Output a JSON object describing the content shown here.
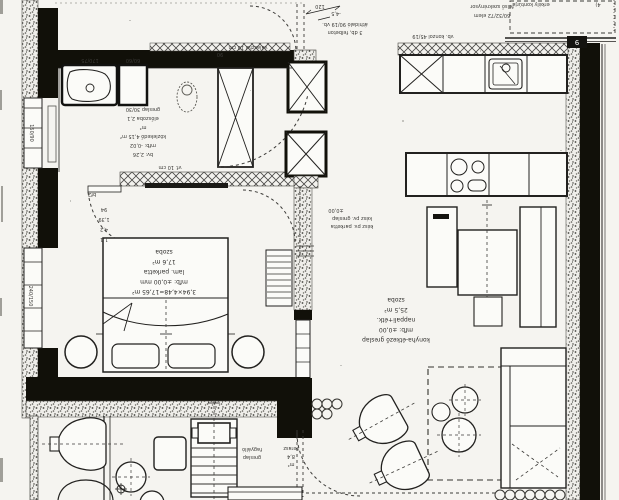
{
  "document": {
    "type": "scanned floor plan (rotated 180°)",
    "badge": "9",
    "corner_mark": "4)"
  },
  "colors": {
    "paper": "#f5f4f0",
    "ink": "#22211f",
    "wall_black": "#111009",
    "hatch": "#4a4947",
    "dash": "#3c3b38"
  },
  "labels": {
    "bath": {
      "lines": [
        "greslap 30/30",
        "előszoba 2,1",
        "m²",
        "közlekedő 4,15 m²",
        "mfb: -0,02",
        "bv: 2,26"
      ]
    },
    "bedroom": {
      "lines": [
        "szoba",
        "17,6 m²",
        "lam. parketta",
        "mfb: ±0,00 mm",
        "3,94×4,48=17,65 m²"
      ]
    },
    "living": {
      "lines": [
        "szoba",
        "25,5 m²",
        "nappali+étk.",
        "mfb: ±0,00",
        "konyha-étkező greslap"
      ]
    },
    "level_note": {
      "lines": [
        "±0,00",
        "kész pv. greslap",
        "kész pv. parketta"
      ]
    },
    "top_note": {
      "lines": [
        "áthidaló 90/19 vb.",
        "3 db, felbeton"
      ],
      "dim": "120",
      "mark": "-4,5"
    },
    "kitchen_note": {
      "lines": [
        "felső szekrénysor",
        "60/32/72 elem"
      ]
    },
    "terrace": {
      "note_lines": [
        "fagyálló",
        "greslap"
      ],
      "col_lines": [
        "terasz",
        "8,4",
        "m²"
      ]
    },
    "hatch_label_top": "válaszfal 10 cm",
    "hatch_label_mid": "vf. 10 cm",
    "kitchen_hatch_label": "vb. konzol 45/19",
    "balcony_note": "erkély kontúrja",
    "door_code": "bf2",
    "entry_dim": "90",
    "dim_stack": [
      "94",
      "1,39",
      "4,2",
      "1,1"
    ],
    "window_left": "150/90",
    "window_bedroom": "240/150",
    "fixture_tub": "170/75",
    "fixture_shower": "60/60"
  }
}
